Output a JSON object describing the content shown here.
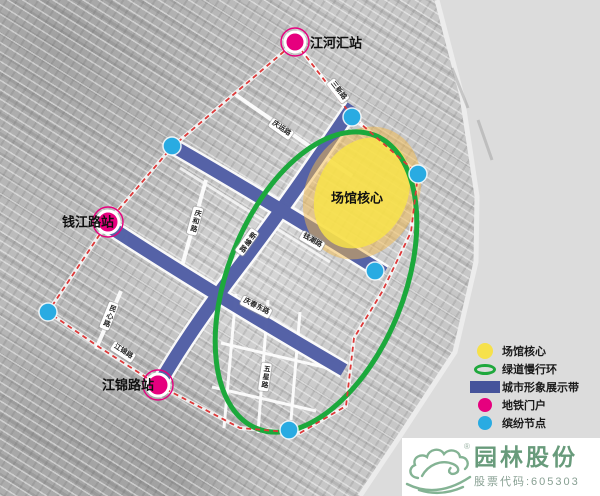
{
  "map": {
    "stations": [
      {
        "id": "jianghehui",
        "name": "江河汇站"
      },
      {
        "id": "qianjianglu",
        "name": "钱江路站"
      },
      {
        "id": "jiangjinlu",
        "name": "江锦路站"
      }
    ],
    "venue_core_label": "场馆核心",
    "roads": [
      {
        "name": "三新路"
      },
      {
        "name": "庆运路"
      },
      {
        "name": "庆和路"
      },
      {
        "name": "新塘路"
      },
      {
        "name": "钱潮路"
      },
      {
        "name": "庆春东路"
      },
      {
        "name": "民心路"
      },
      {
        "name": "江锦路"
      },
      {
        "name": "五星路"
      }
    ]
  },
  "legend": {
    "items": [
      {
        "swatch": "yellow-circle",
        "label": "场馆核心",
        "color": "#f6e14b"
      },
      {
        "swatch": "green-ellipse-outline",
        "label": "绿道慢行环",
        "color": "#1fa83c"
      },
      {
        "swatch": "blue-rect",
        "label": "城市形象展示带",
        "color": "#46549b"
      },
      {
        "swatch": "magenta-circle",
        "label": "地铁门户",
        "color": "#e6007e"
      },
      {
        "swatch": "cyan-circle",
        "label": "缤纷节点",
        "color": "#29abe2"
      }
    ]
  },
  "branding": {
    "company": "园林股份",
    "stock_code": "股票代码:605303",
    "registered": "®"
  },
  "palette": {
    "band_blue": "#3f4e9c",
    "greenway_green": "#1ca93c",
    "venue_yellow": "#f6e14b",
    "venue_halo_orange": "#f3ba4a",
    "metro_magenta": "#e6007e",
    "node_cyan": "#29abe2",
    "boundary_red": "#dd3838",
    "logo_green": "#84b394"
  }
}
